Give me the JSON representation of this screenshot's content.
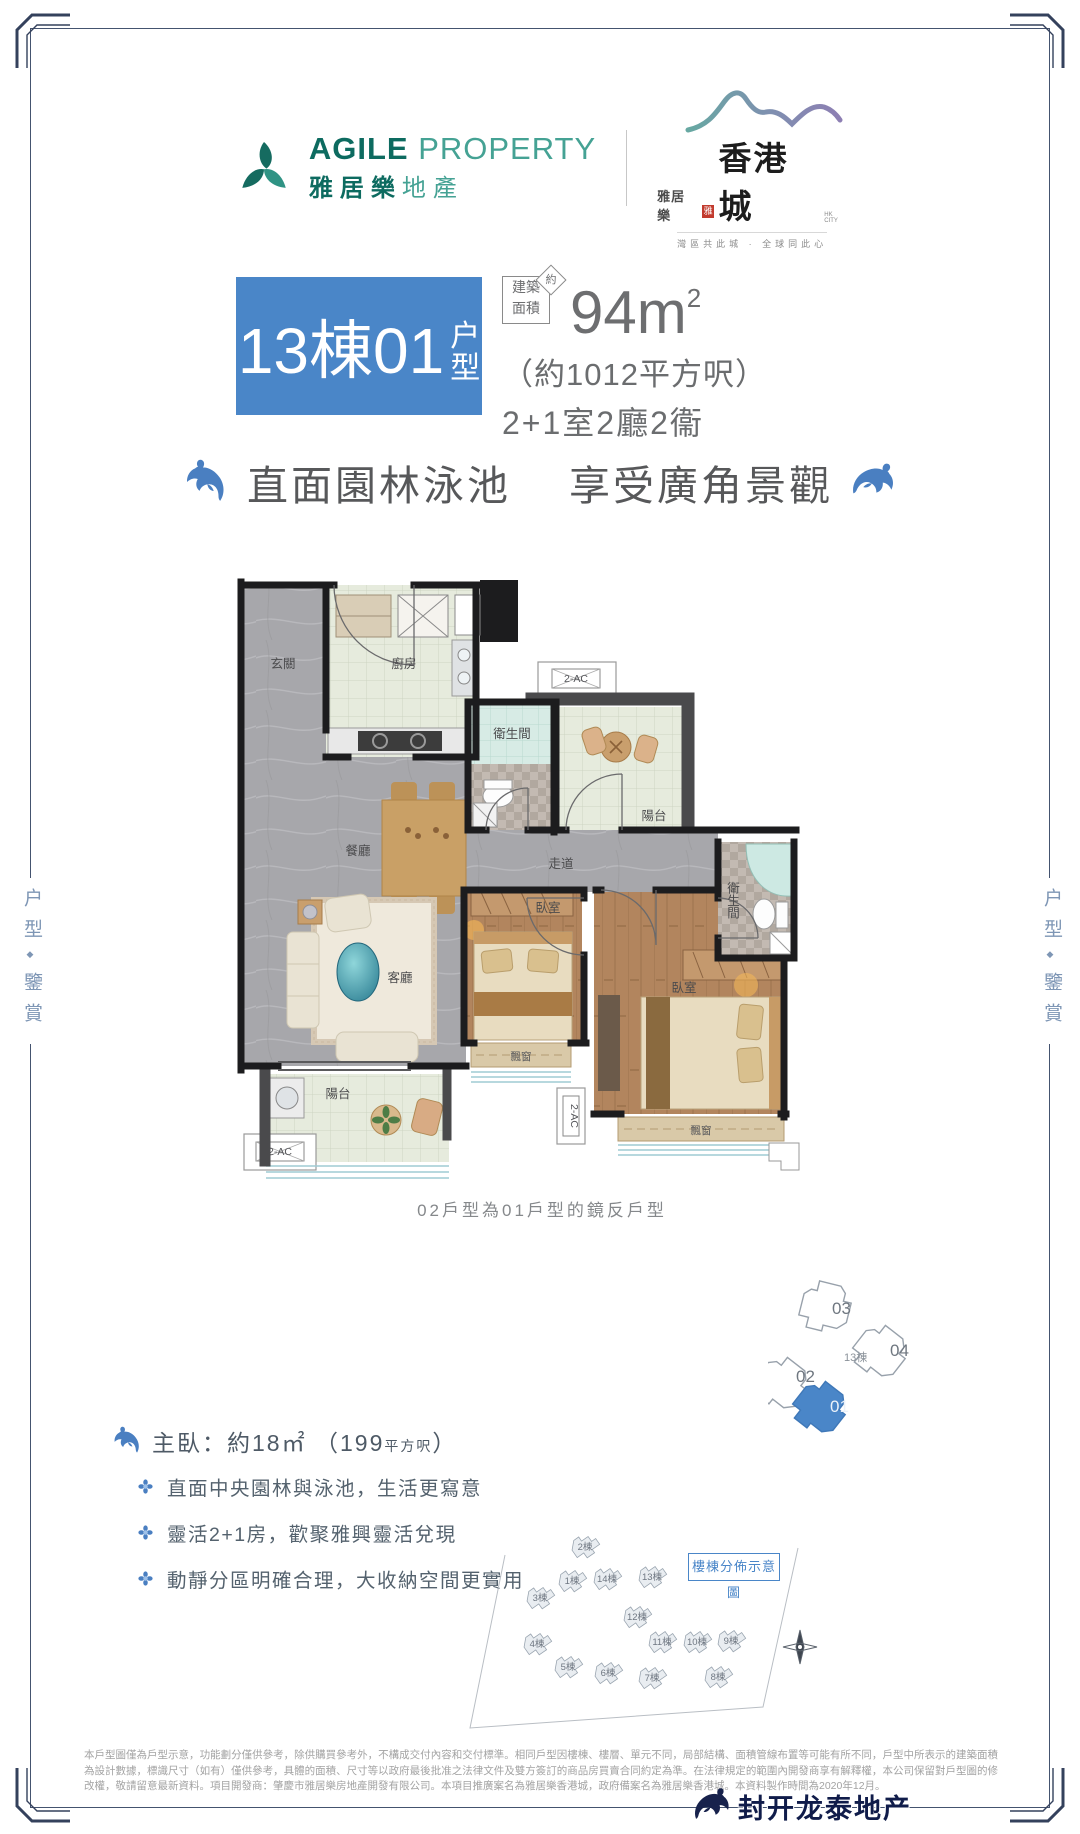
{
  "page": {
    "width": 1080,
    "height": 1834,
    "bg": "#ffffff",
    "frame_color": "#44536f",
    "accent_blue": "#4a86c8",
    "dolphin_blue": "#4a7fc1"
  },
  "side_label": {
    "top": "户型",
    "divider": "◆",
    "bottom": "鑒賞"
  },
  "header": {
    "agile": {
      "en_bold": "AGILE",
      "en_light": "PROPERTY",
      "cn_bold": "雅居樂",
      "cn_light": "地產",
      "color_dark": "#0d6b60",
      "color_light": "#45a294"
    },
    "hkcity": {
      "pre": "雅居樂",
      "seal": "雅",
      "name": "香港城",
      "sub": "HK CITY",
      "tagline": "灣區共此城 · 全球同此心"
    }
  },
  "title": {
    "block_main": "13棟01",
    "block_suffix_1": "户",
    "block_suffix_2": "型",
    "area_chip_1": "建築",
    "area_chip_2": "面積",
    "area_approx": "約",
    "area_value": "94m",
    "area_sup": "2",
    "area_hk": "（約1012平方呎）",
    "layout": "2+1室2廳2衞"
  },
  "headline": {
    "left": "直面園林泳池",
    "right": "享受廣角景觀"
  },
  "floorplan": {
    "rooms": {
      "entry": "玄關",
      "kitchen": "廚房",
      "bath": "衛生間",
      "balcony": "陽台",
      "dining": "餐廳",
      "corridor": "走道",
      "living": "客廳",
      "bedroom": "臥室",
      "bay": "飄窗",
      "ac": "2-AC"
    },
    "caption": "02戶型為01戶型的鏡反戶型"
  },
  "unit_key": {
    "center": "13棟",
    "u03": "03",
    "u04": "04",
    "u02": "02",
    "u01": "01",
    "highlight": "01"
  },
  "master": {
    "label": "主臥：",
    "area": "約18㎡",
    "paren": "（199",
    "paren_small": "平方呎",
    "paren_close": "）"
  },
  "bullets": [
    "直面中央園林與泳池，生活更寫意",
    "靈活2+1房，歡聚雅興靈活兌現",
    "動靜分區明確合理，大收納空間更實用"
  ],
  "siteplan": {
    "title": "樓棟分佈示意圖",
    "buildings": [
      {
        "label": "2棟",
        "x": 117,
        "y": 41
      },
      {
        "label": "1棟",
        "x": 104,
        "y": 75
      },
      {
        "label": "14棟",
        "x": 139,
        "y": 73
      },
      {
        "label": "13棟",
        "x": 184,
        "y": 71
      },
      {
        "label": "3棟",
        "x": 72,
        "y": 92
      },
      {
        "label": "12棟",
        "x": 169,
        "y": 111
      },
      {
        "label": "4棟",
        "x": 69,
        "y": 138
      },
      {
        "label": "11棟",
        "x": 194,
        "y": 136
      },
      {
        "label": "10棟",
        "x": 229,
        "y": 136
      },
      {
        "label": "9棟",
        "x": 263,
        "y": 135
      },
      {
        "label": "5棟",
        "x": 100,
        "y": 161
      },
      {
        "label": "6棟",
        "x": 140,
        "y": 167
      },
      {
        "label": "7棟",
        "x": 184,
        "y": 172
      },
      {
        "label": "8棟",
        "x": 250,
        "y": 171
      }
    ]
  },
  "disclaimer": "本戶型圖僅為戶型示意，功能劃分僅供參考，除供購買參考外，不構成交付內容和交付標準。相同戶型因樓棟、樓層、單元不同，局部結構、面積管線布置等可能有所不同，戶型中所表示的建築面積為設計數據，標識尺寸（如有）僅供參考，具體的面積、尺寸等以政府最後批准之法律文件及雙方簽訂的商品房買賣合同約定為準。在法律規定的範圍內開發商享有解釋權，本公司保留對戶型圖的修改權，敬請留意最新資料。項目開發商：肇慶市雅居樂房地產開發有限公司。本項目推廣案名為雅居樂香港城，政府備案名為雅居樂香港城。本資料製作時間為2020年12月。",
  "watermark": "封开龙泰地产"
}
